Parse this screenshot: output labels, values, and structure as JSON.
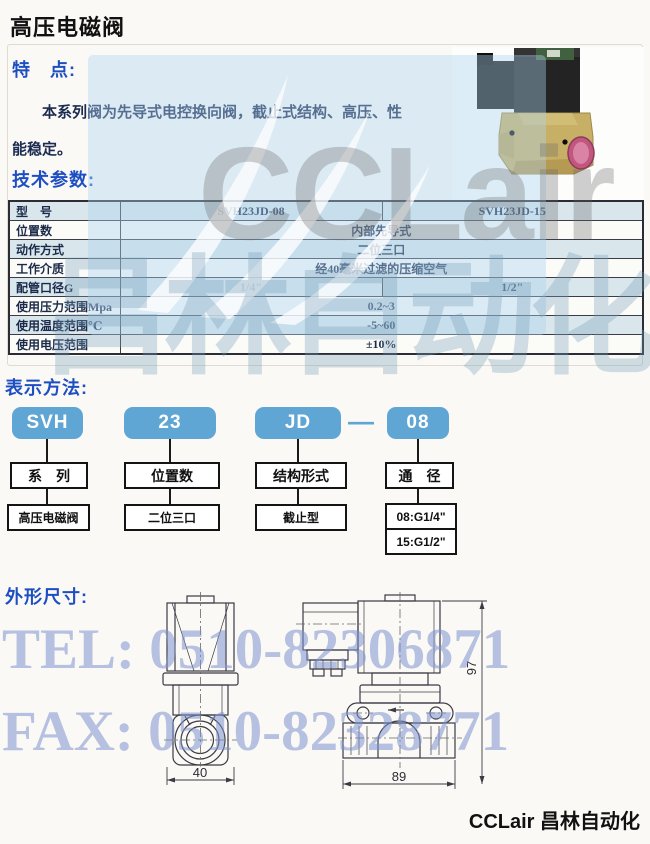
{
  "page": {
    "title": "高压电磁阀",
    "footer": "CCLair 昌林自动化"
  },
  "features": {
    "heading": "特　点:",
    "line1": "本系列阀为先导式电控换向阀，截止式结构、高压、性",
    "line2": "能稳定。"
  },
  "tech": {
    "heading": "技术参数:"
  },
  "spec_table": {
    "rows": [
      {
        "label": "型　号",
        "values": [
          "SVH23JD-08",
          "SVH23JD-15"
        ]
      },
      {
        "label": "位置数",
        "value": "内部先导式"
      },
      {
        "label": "动作方式",
        "value": "二位三口"
      },
      {
        "label": "工作介质",
        "value": "经40毫米过滤的压缩空气"
      },
      {
        "label": "配管口径G",
        "values": [
          "1/4\"",
          "1/2\""
        ]
      },
      {
        "label": "使用压力范围Mpa",
        "value": "0.2~3"
      },
      {
        "label": "使用温度范围℃",
        "value": "-5~60"
      },
      {
        "label": "使用电压范围",
        "value": "±10%"
      }
    ]
  },
  "designation": {
    "heading": "表示方法:",
    "pills": [
      "SVH",
      "23",
      "JD",
      "08"
    ],
    "dash": "—",
    "level1": [
      "系　列",
      "位置数",
      "结构形式",
      "通　径"
    ],
    "level2": [
      "高压电磁阀",
      "二位三口",
      "截止型"
    ],
    "bore_options": [
      "08:G1/4\"",
      "15:G1/2\""
    ]
  },
  "dimensions": {
    "heading": "外形尺寸:",
    "front_width": "40",
    "side_width": "89",
    "side_height": "97"
  },
  "watermarks": {
    "brand_latin": "CCLair",
    "brand_cn": "昌林自动化",
    "tel": "TEL: 0510-82306871",
    "fax": "FAX: 0510-82328771"
  },
  "colors": {
    "heading_blue": "#1e4fc2",
    "pill_blue": "#5fa6d4",
    "row_tint": "#d9e7ec",
    "watermark_blue": "#add5f0",
    "coil_black": "#1e1e1e",
    "body_brass": "#c7b065",
    "port_pink": "#c2567e"
  }
}
